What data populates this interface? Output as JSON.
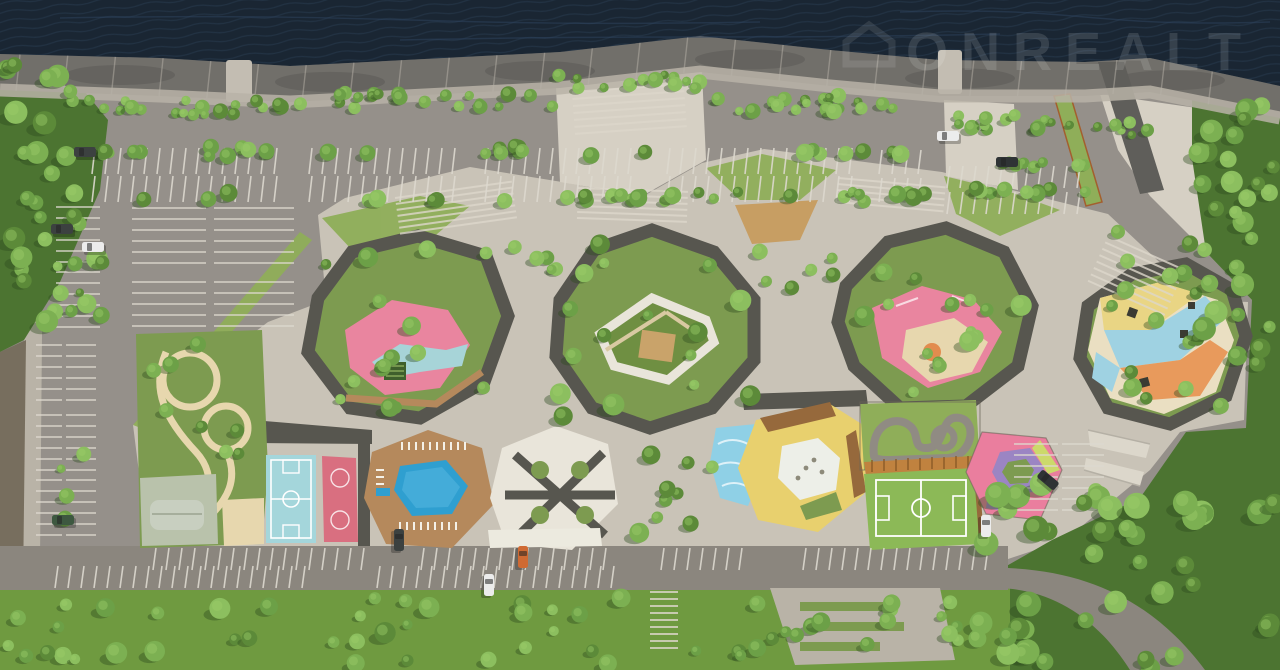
{
  "meta": {
    "description": "Aerial architectural rendering of a riverside residential complex with park, playgrounds, sports courts and parking",
    "width": 1280,
    "height": 670
  },
  "watermark": {
    "text": "ONREALT",
    "opacity": 0.12,
    "color": "#ffffff"
  },
  "palette": {
    "water": "#1a2633",
    "waterline": "#2e4360",
    "quay": "#716f6a",
    "quaySeam": "#b7b2a8",
    "asphalt": "#95908a",
    "stall": "#ddd9cf",
    "paving": "#c9c3b7",
    "pavingBright": "#d6d0c4",
    "sidewalk": "#b9b3a7",
    "soil": "#776e5e",
    "roofDark": "#57564f",
    "road": "#8b867e",
    "lawn": "#7d9b50",
    "lawnLight": "#8fae59",
    "forest": "#4c7431",
    "treeShadow": "#2e4a1f",
    "tree1": "#5c8a39",
    "tree2": "#6ca047",
    "tree3": "#7cb052",
    "tree4": "#8cbf5f",
    "woodDeck": "#b5895c",
    "woodDark": "#96693c",
    "tan": "#c79e63",
    "pink": "#e9859f",
    "pinkDeep": "#df6f8d",
    "blueSoft": "#a7d4d8",
    "sand": "#e7d7ae",
    "poolBlue": "#2f9fd0",
    "courtBlue": "#a4d6db",
    "courtPink": "#d96f80",
    "yellowZone": "#e8d06e",
    "orangeZone": "#e28c4e",
    "purple": "#9b85c3",
    "lime": "#ccd96b",
    "whiteRoof": "#e9e5da",
    "skate": "#b9c2ab",
    "ramp": "#dcd7cb"
  },
  "scene": {
    "quay": {
      "top": [
        [
          0,
          54
        ],
        [
          160,
          58
        ],
        [
          290,
          66
        ],
        [
          560,
          52
        ],
        [
          700,
          36
        ],
        [
          830,
          50
        ],
        [
          940,
          60
        ],
        [
          1085,
          62
        ],
        [
          1150,
          58
        ],
        [
          1280,
          86
        ]
      ],
      "bottom": [
        [
          0,
          90
        ],
        [
          160,
          96
        ],
        [
          290,
          102
        ],
        [
          560,
          88
        ],
        [
          700,
          72
        ],
        [
          830,
          86
        ],
        [
          940,
          96
        ],
        [
          1085,
          96
        ],
        [
          1150,
          92
        ],
        [
          1280,
          118
        ]
      ],
      "seams": 26
    },
    "tree_areas": [
      [
        64,
        100,
        230,
        16,
        22,
        4,
        8
      ],
      [
        298,
        92,
        256,
        16,
        22,
        4,
        8
      ],
      [
        556,
        74,
        146,
        16,
        13,
        4,
        8
      ],
      [
        704,
        94,
        238,
        18,
        22,
        4,
        8
      ],
      [
        944,
        114,
        150,
        16,
        14,
        4,
        8
      ],
      [
        1096,
        122,
        52,
        14,
        6,
        4,
        7
      ],
      [
        96,
        146,
        832,
        10,
        30,
        5,
        9
      ],
      [
        96,
        192,
        832,
        10,
        30,
        5,
        9
      ],
      [
        952,
        160,
        140,
        8,
        9,
        5,
        8
      ],
      [
        952,
        188,
        140,
        8,
        9,
        5,
        8
      ],
      [
        318,
        238,
        190,
        170,
        15,
        5,
        11
      ],
      [
        560,
        238,
        195,
        185,
        16,
        5,
        11
      ],
      [
        846,
        234,
        190,
        165,
        15,
        5,
        11
      ],
      [
        1086,
        270,
        155,
        150,
        12,
        5,
        10
      ],
      [
        500,
        244,
        58,
        52,
        5,
        4,
        8
      ],
      [
        756,
        236,
        88,
        54,
        6,
        4,
        8
      ],
      [
        614,
        436,
        112,
        108,
        9,
        5,
        10
      ],
      [
        138,
        336,
        120,
        120,
        8,
        5,
        9
      ],
      [
        1100,
        228,
        92,
        64,
        6,
        5,
        9
      ],
      [
        0,
        58,
        108,
        286,
        30,
        6,
        12
      ],
      [
        1196,
        92,
        84,
        320,
        28,
        6,
        12
      ],
      [
        972,
        478,
        306,
        190,
        42,
        7,
        13
      ],
      [
        4,
        596,
        640,
        68,
        36,
        5,
        11
      ],
      [
        652,
        600,
        330,
        64,
        20,
        5,
        10
      ],
      [
        56,
        210,
        28,
        330,
        9,
        4,
        8
      ]
    ],
    "combs_v": [
      [
        95,
        278,
        148,
        26
      ],
      [
        312,
        462,
        148,
        26
      ],
      [
        488,
        642,
        148,
        26
      ],
      [
        670,
        856,
        148,
        26
      ],
      [
        882,
        928,
        150,
        24
      ],
      [
        95,
        278,
        176,
        26
      ],
      [
        312,
        462,
        176,
        26
      ],
      [
        488,
        642,
        176,
        26
      ],
      [
        670,
        856,
        176,
        26
      ],
      [
        882,
        928,
        178,
        24
      ],
      [
        950,
        1092,
        166,
        22
      ],
      [
        950,
        1092,
        192,
        22
      ],
      [
        156,
        372,
        548,
        22
      ],
      [
        424,
        618,
        548,
        22
      ],
      [
        664,
        752,
        548,
        22
      ],
      [
        806,
        994,
        548,
        22
      ],
      [
        58,
        306,
        566,
        22
      ],
      [
        380,
        618,
        566,
        22
      ]
    ],
    "combs_h": [
      [
        208,
        268,
        132,
        74
      ],
      [
        208,
        268,
        214,
        80
      ],
      [
        282,
        330,
        132,
        74
      ],
      [
        282,
        330,
        214,
        80
      ],
      [
        207,
        262,
        56,
        44
      ],
      [
        272,
        330,
        56,
        44
      ],
      [
        345,
        405,
        36,
        26
      ],
      [
        345,
        405,
        66,
        30
      ],
      [
        415,
        470,
        36,
        26
      ],
      [
        415,
        470,
        66,
        30
      ],
      [
        480,
        540,
        36,
        26
      ],
      [
        480,
        540,
        66,
        30
      ],
      [
        444,
        520,
        1014,
        44
      ],
      [
        444,
        520,
        1062,
        42
      ]
    ],
    "stairs": [
      {
        "x": 395,
        "y": 198,
        "w": 118,
        "h": 36,
        "gap": 6,
        "rot": -8
      },
      {
        "x": 572,
        "y": 92,
        "w": 112,
        "h": 46,
        "gap": 7,
        "rot": -4
      },
      {
        "x": 578,
        "y": 188,
        "w": 110,
        "h": 30,
        "gap": 6,
        "rot": 2
      },
      {
        "x": 838,
        "y": 178,
        "w": 108,
        "h": 28,
        "gap": 6,
        "rot": 5
      },
      {
        "x": 1108,
        "y": 236,
        "w": 84,
        "h": 54,
        "gap": 7,
        "rot": 24
      },
      {
        "x": 650,
        "y": 592,
        "w": 28,
        "h": 56,
        "gap": 7,
        "rot": 0
      }
    ],
    "cars": [
      {
        "x": 62,
        "y": 229,
        "r": 0,
        "c": "#3c4140"
      },
      {
        "x": 93,
        "y": 247,
        "r": 0,
        "c": "#ececec"
      },
      {
        "x": 85,
        "y": 152,
        "r": 0,
        "c": "#3c4140"
      },
      {
        "x": 948,
        "y": 136,
        "r": 0,
        "c": "#ececec"
      },
      {
        "x": 1007,
        "y": 162,
        "r": 0,
        "c": "#2f3335"
      },
      {
        "x": 63,
        "y": 520,
        "r": 0,
        "c": "#3d5840"
      },
      {
        "x": 399,
        "y": 540,
        "r": 90,
        "c": "#3c4140"
      },
      {
        "x": 489,
        "y": 585,
        "r": 90,
        "c": "#ececec"
      },
      {
        "x": 523,
        "y": 557,
        "r": 90,
        "c": "#cf6a33"
      },
      {
        "x": 986,
        "y": 526,
        "r": 90,
        "c": "#ececec"
      },
      {
        "x": 1048,
        "y": 480,
        "r": 40,
        "c": "#2f3335"
      }
    ]
  }
}
